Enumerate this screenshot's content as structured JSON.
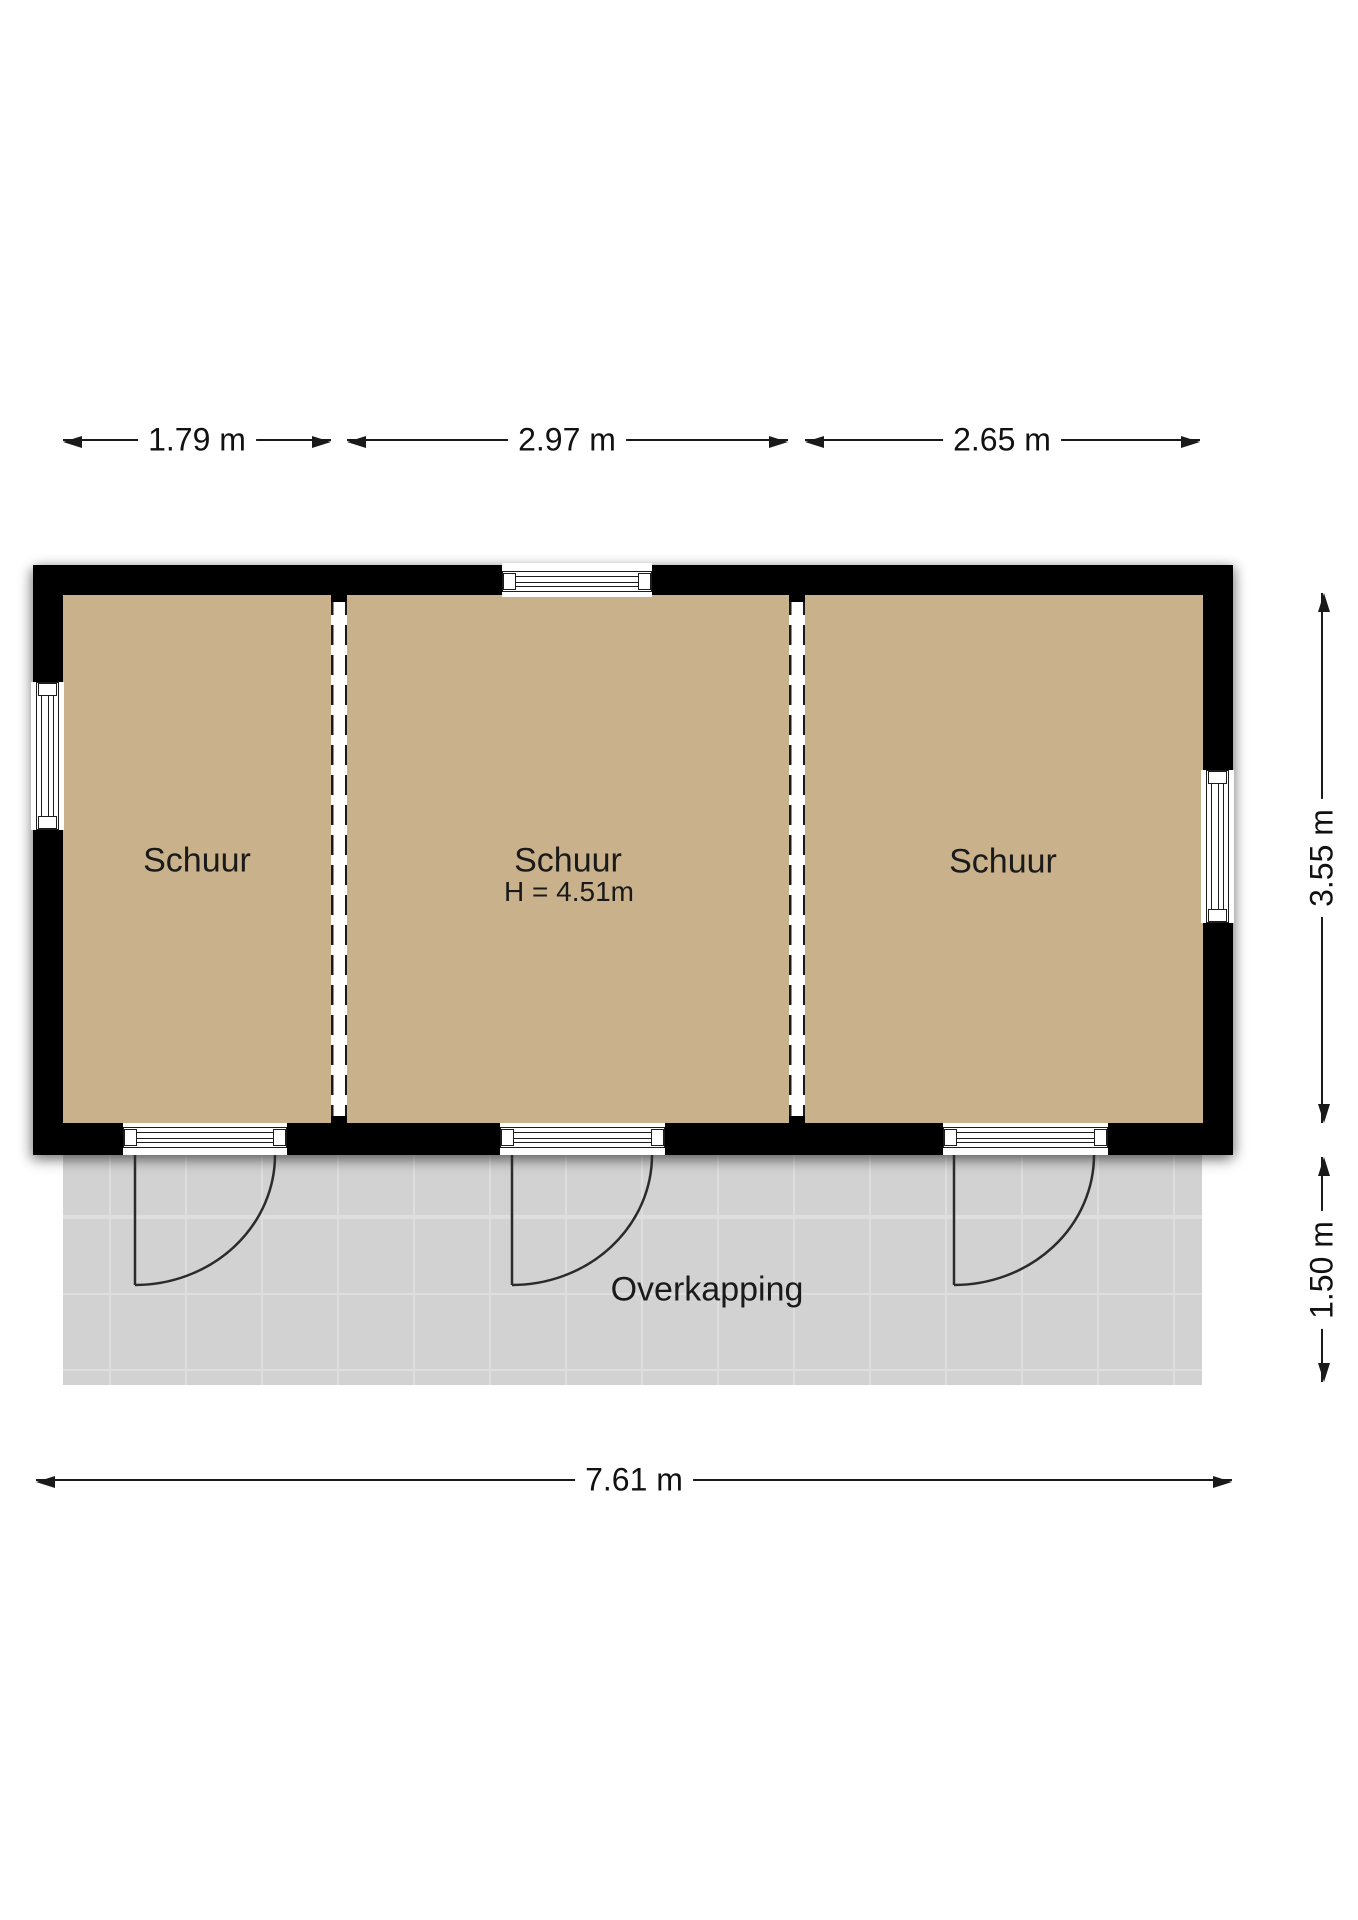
{
  "colors": {
    "wall": "#000000",
    "floor": "#c9b18c",
    "canopy": "#d2d2d2",
    "canopy_line": "#dedede",
    "line": "#1a1a1a"
  },
  "rooms": [
    {
      "label": "Schuur"
    },
    {
      "label": "Schuur",
      "height_label": "H = 4.51m"
    },
    {
      "label": "Schuur"
    }
  ],
  "canopy": {
    "label": "Overkapping"
  },
  "dimensions": {
    "top": [
      {
        "label": "1.79 m"
      },
      {
        "label": "2.97 m"
      },
      {
        "label": "2.65 m"
      }
    ],
    "right": [
      {
        "label": "3.55 m"
      },
      {
        "label": "1.50 m"
      }
    ],
    "bottom": {
      "label": "7.61 m"
    }
  }
}
